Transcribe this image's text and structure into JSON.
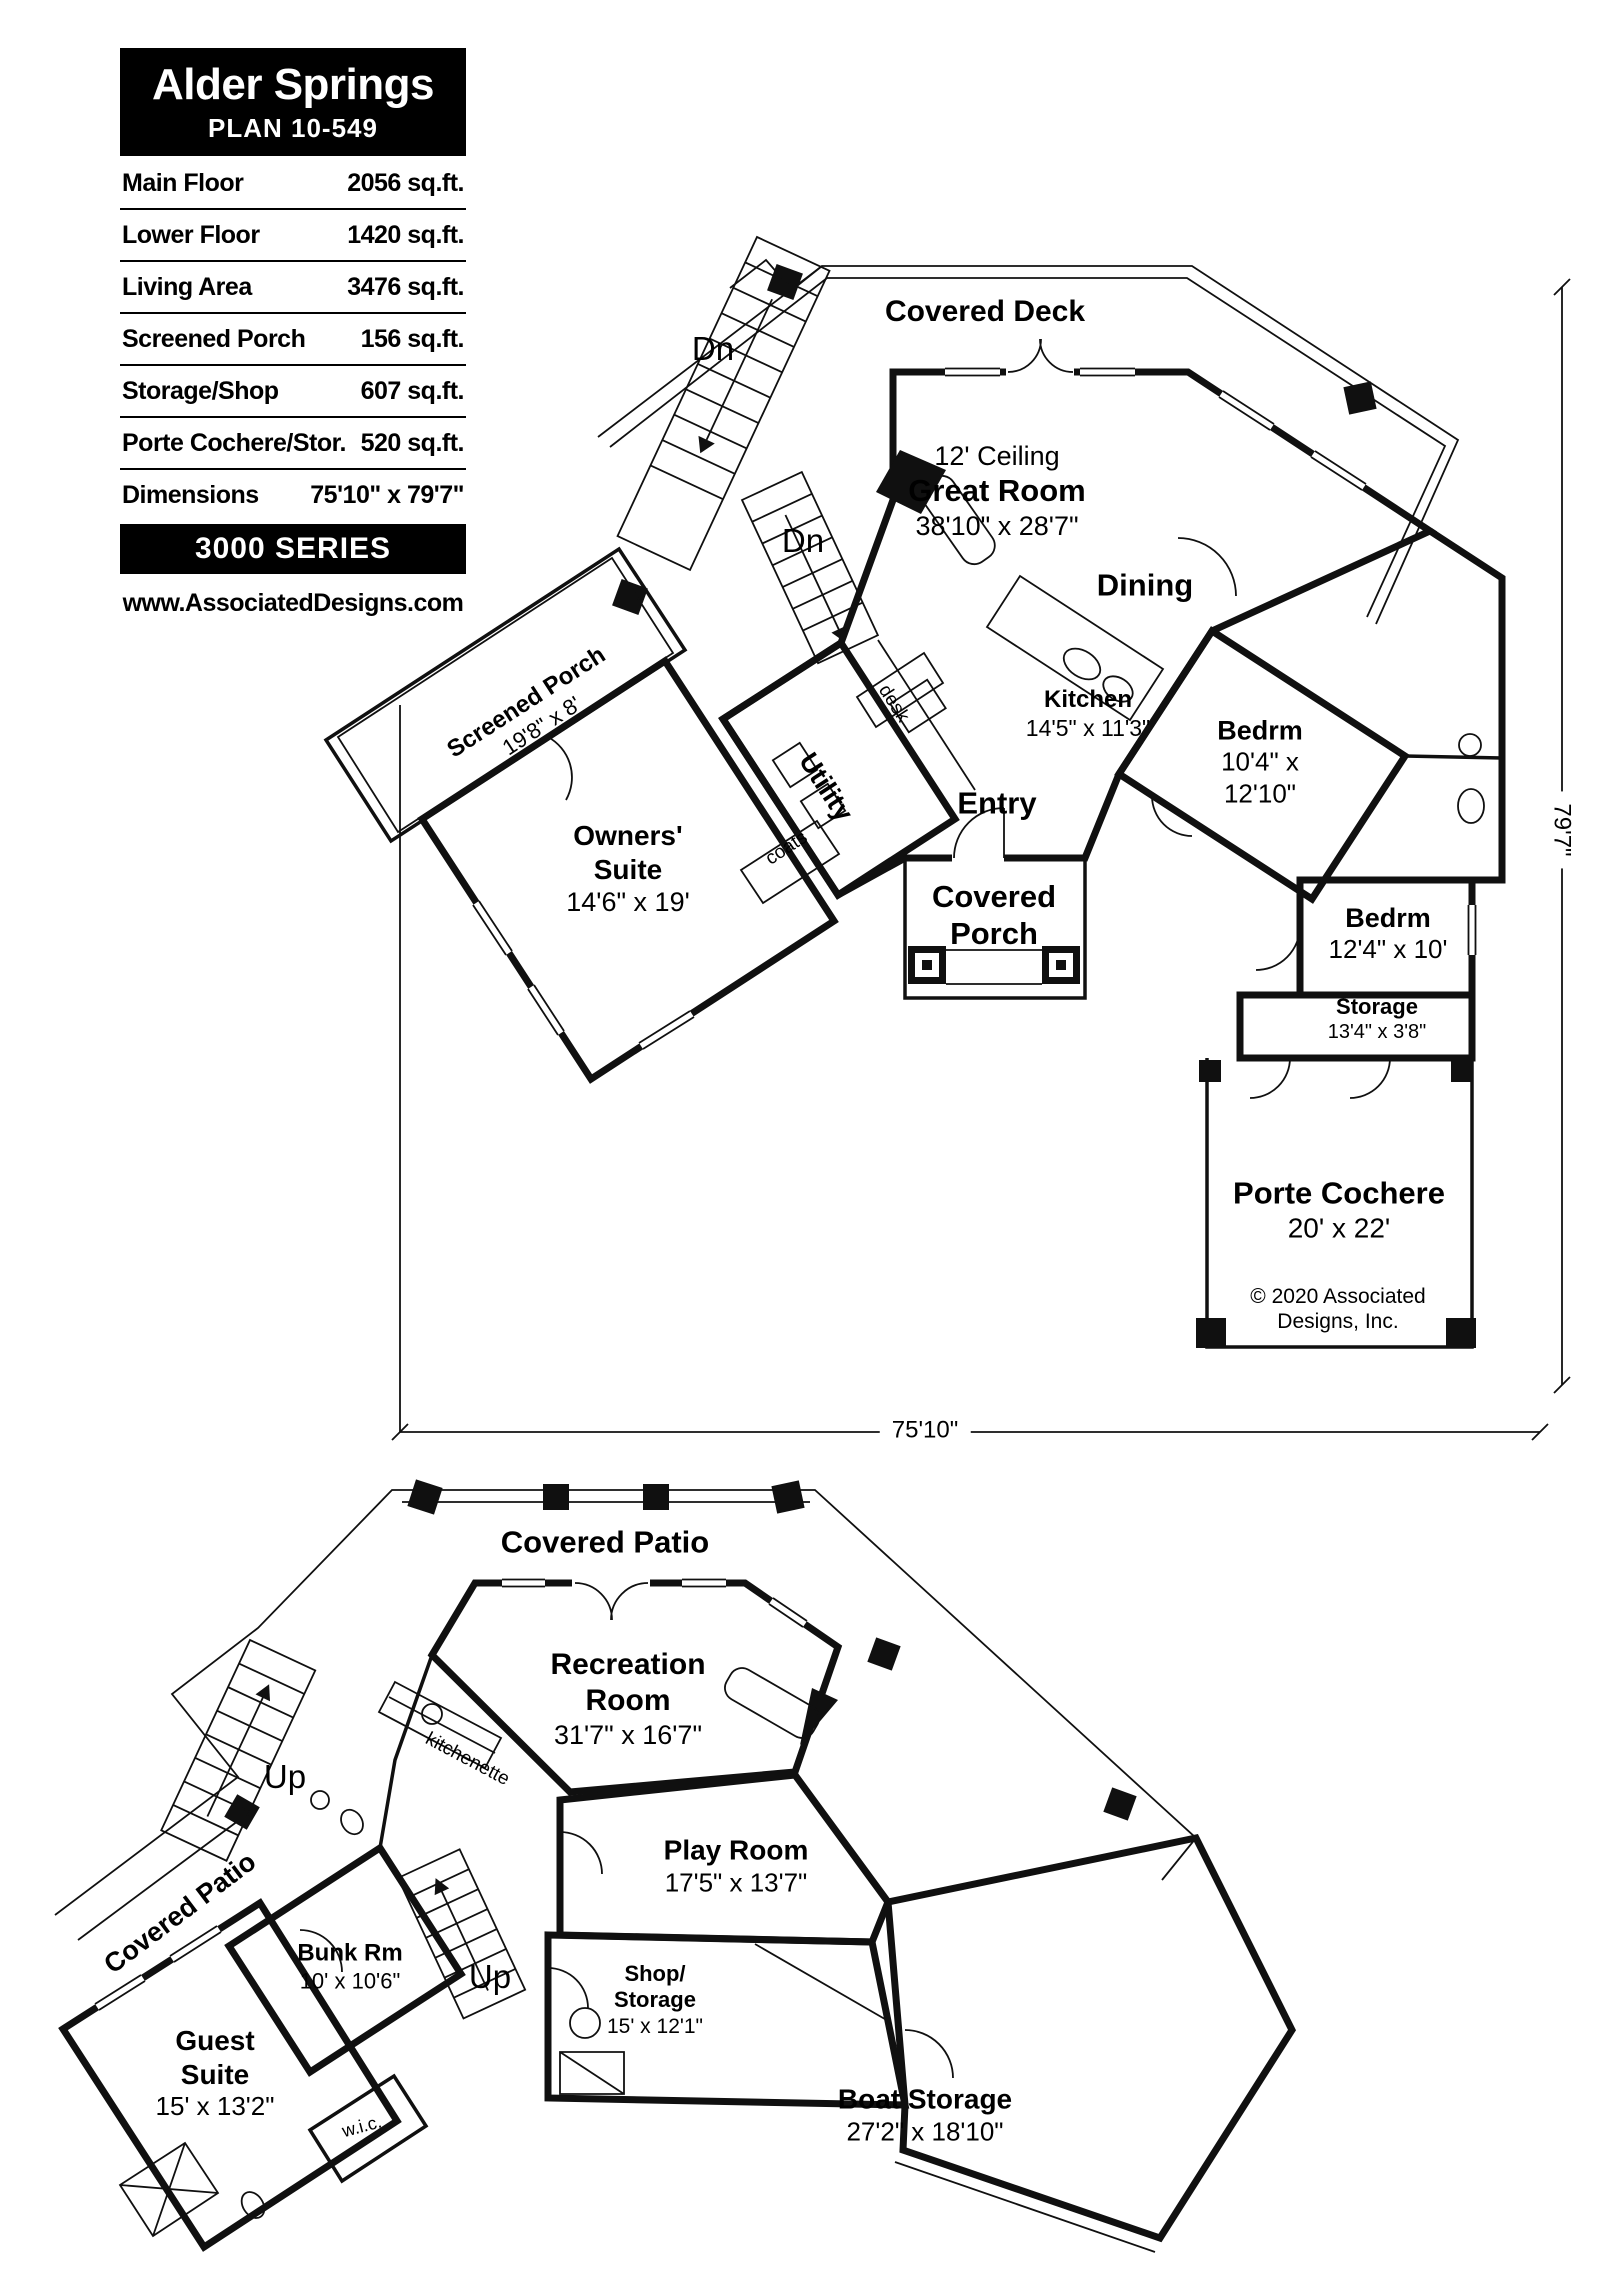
{
  "colors": {
    "ink": "#101010",
    "paper": "#ffffff"
  },
  "info_box": {
    "title": "Alder Springs",
    "plan_number": "PLAN 10-549",
    "rows": [
      {
        "label": "Main Floor",
        "value": "2056 sq.ft."
      },
      {
        "label": "Lower Floor",
        "value": "1420 sq.ft."
      },
      {
        "label": "Living Area",
        "value": "3476 sq.ft."
      },
      {
        "label": "Screened Porch",
        "value": "156 sq.ft."
      },
      {
        "label": "Storage/Shop",
        "value": "607 sq.ft."
      },
      {
        "label": "Porte Cochere/Stor.",
        "value": "520 sq.ft."
      },
      {
        "label": "Dimensions",
        "value": "75'10\" x 79'7\""
      }
    ],
    "series": "3000 SERIES",
    "website": "www.AssociatedDesigns.com"
  },
  "main_floor": {
    "covered_deck": "Covered Deck",
    "stairs_down_outside": "Dn",
    "stairs_down_inside": "Dn",
    "great_room": {
      "note": "12' Ceiling",
      "name": "Great Room",
      "dims": "38'10\" x 28'7\""
    },
    "dining": "Dining",
    "kitchen": {
      "name": "Kitchen",
      "dims": "14'5\" x 11'3\""
    },
    "desk": "desk",
    "utility": "Utility",
    "coats": "coats",
    "screened_porch": {
      "name": "Screened Porch",
      "dims": "19'8\" x 8'"
    },
    "owners_suite": {
      "name_line1": "Owners'",
      "name_line2": "Suite",
      "dims": "14'6\" x 19'"
    },
    "entry": "Entry",
    "covered_porch": {
      "line1": "Covered",
      "line2": "Porch"
    },
    "bedroom_upper": {
      "name": "Bedrm",
      "dims_line1": "10'4\" x",
      "dims_line2": "12'10\""
    },
    "bedroom_lower": {
      "name": "Bedrm",
      "dims": "12'4\" x 10'"
    },
    "storage": {
      "name": "Storage",
      "dims": "13'4\" x 3'8\""
    },
    "porte_cochere": {
      "name": "Porte Cochere",
      "dims": "20' x 22'"
    },
    "copyright": {
      "line1": "© 2020 Associated",
      "line2": "Designs, Inc."
    },
    "dim_width": "75'10\"",
    "dim_height": "79'7\""
  },
  "lower_floor": {
    "covered_patio_top": "Covered Patio",
    "covered_patio_left": "Covered Patio",
    "stairs_up_outside": "Up",
    "stairs_up_inside": "Up",
    "recreation_room": {
      "name_line1": "Recreation",
      "name_line2": "Room",
      "dims": "31'7\" x 16'7\""
    },
    "kitchenette": "kitchenette",
    "bunk_room": {
      "name": "Bunk Rm",
      "dims": "10' x 10'6\""
    },
    "play_room": {
      "name": "Play Room",
      "dims": "17'5\" x 13'7\""
    },
    "shop_storage": {
      "line1": "Shop/",
      "line2": "Storage",
      "dims": "15' x 12'1\""
    },
    "guest_suite": {
      "name_line1": "Guest",
      "name_line2": "Suite",
      "dims": "15' x 13'2\""
    },
    "wic": "w.i.c.",
    "boat_storage": {
      "name": "Boat Storage",
      "dims": "27'2\" x 18'10\""
    }
  }
}
